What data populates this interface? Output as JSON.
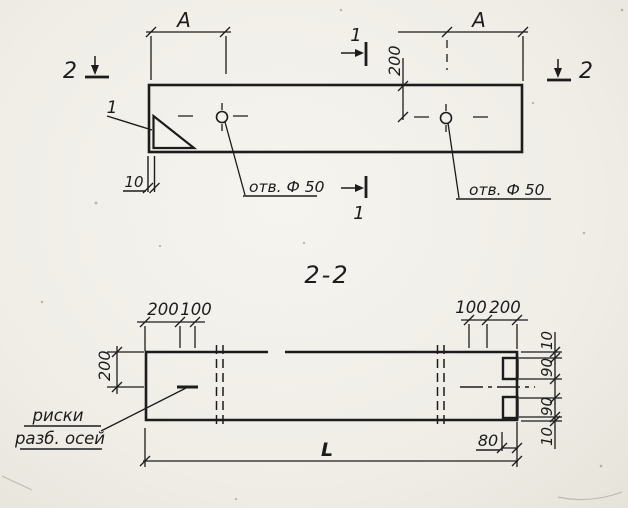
{
  "plan_view": {
    "dim_a_left": "A",
    "dim_a_right": "A",
    "dim_200_vertical": "200",
    "dim_10_left": "10",
    "hole_left_label": "отв. Ф 50",
    "hole_right_label": "отв. Ф 50",
    "section_mark_1_top": "1",
    "section_mark_1_bottom": "1",
    "section_mark_2_left": "2",
    "section_mark_2_right": "2",
    "detail_callout": "1"
  },
  "section_view": {
    "title": "2-2",
    "top_left_dims": [
      "200",
      "100"
    ],
    "top_right_dims": [
      "100",
      "200"
    ],
    "side_left_dim": "200",
    "right_chain_dims": [
      "10",
      "90",
      "90",
      "10"
    ],
    "dim_80": "80",
    "overall_length": "L",
    "axes_note_line1": "риски",
    "axes_note_line2": "разб. осей"
  },
  "colors": {
    "ink": "#1c1c1c",
    "paper": "#f1efe8"
  }
}
